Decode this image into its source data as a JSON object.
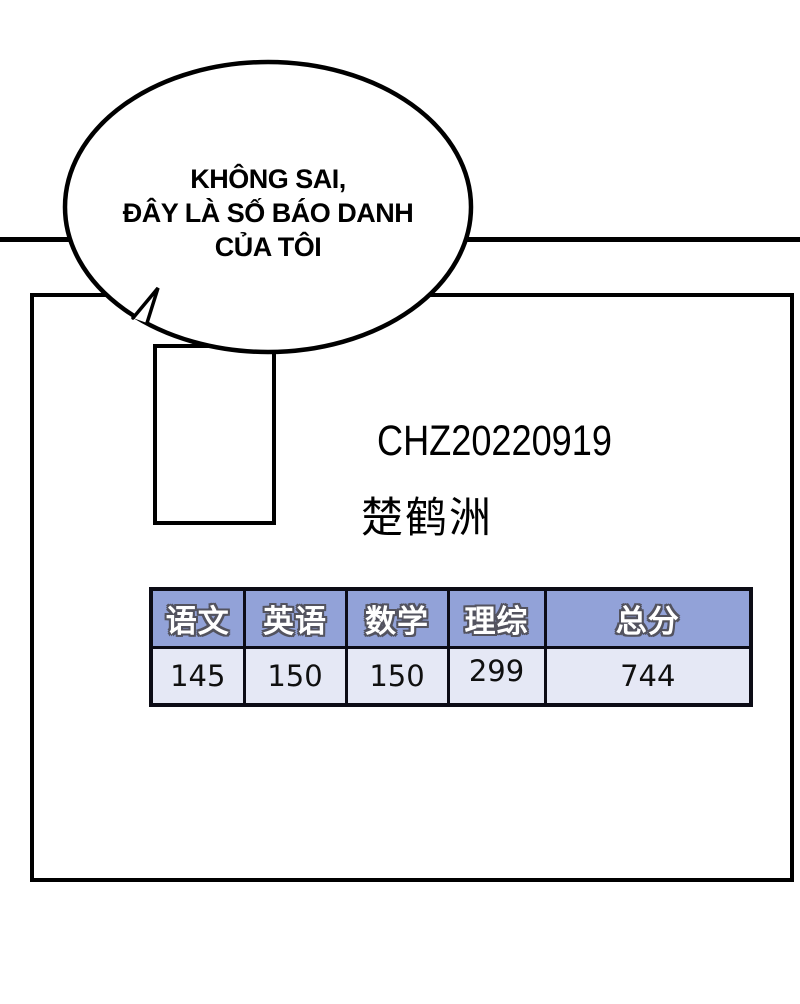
{
  "panel": {
    "speech_bubble": {
      "lines": [
        "KHÔNG SAI,",
        "ĐÂY LÀ SỐ BÁO DANH",
        "CỦA TÔI"
      ]
    },
    "admission_ticket": {
      "exam_number": "CHZ20220919",
      "student_name": "楚鹤洲",
      "score_table": {
        "headers": [
          "语文",
          "英语",
          "数学",
          "理综",
          "总分"
        ],
        "values": [
          "145",
          "150",
          "150",
          "299",
          "744"
        ]
      }
    }
  },
  "colors": {
    "ink": "#000000",
    "table_header_bg": "#92a2d8",
    "table_row_bg": "#e5e8f5",
    "table_border": "#0c0c16",
    "table_header_text": "#ffffff",
    "table_header_text_outline": "#53535f"
  }
}
